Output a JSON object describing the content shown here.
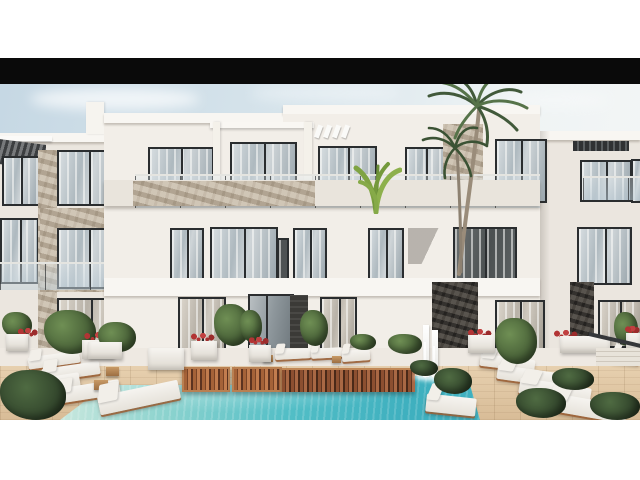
{
  "scene": {
    "type": "architectural-exterior-render",
    "objects": [
      "letterbox-bars",
      "sky",
      "three-story-white-apartment-building",
      "glass-balcony-railings",
      "stone-clad-accents",
      "dark-pergolas",
      "white-pergola-fins",
      "palm-trees",
      "banana-plant-on-balcony",
      "entrance-door",
      "swimming-pool",
      "wooden-slat-bridge",
      "pool-waterfall-feature",
      "wood-deck",
      "white-sun-loungers",
      "white-planters-with-red-flowers",
      "green-shrubs",
      "side-stairs"
    ]
  },
  "palette": {
    "page_bg": "#ffffff",
    "letterbox": "#0a0a0a",
    "sky_left": "#c6d8e4",
    "sky_right": "#f4f6f6",
    "wall_bright": "#f8f6f2",
    "wall_light": "#f2eee8",
    "wall_left": "#ebe6df",
    "frame_dark": "#2a2d2f",
    "stone_light": "#c7bcab",
    "stone_dark": "#4c4844",
    "terrace": "#eee9e2",
    "deck_wood": "#d8bc97",
    "slat_wood": "#8c4f30",
    "pool_shallow": "#cde9df",
    "pool_mid": "#52bec6",
    "pool_deep": "#3fb0bf",
    "lounger_white": "#f6f4f0",
    "lounger_frame": "#9c5f34",
    "plant_green": "#4a6339",
    "plant_dark": "#35492e",
    "flower_red": "#b23434",
    "palm_green": "#41593a",
    "trunk_brown": "#9a8c7a"
  }
}
